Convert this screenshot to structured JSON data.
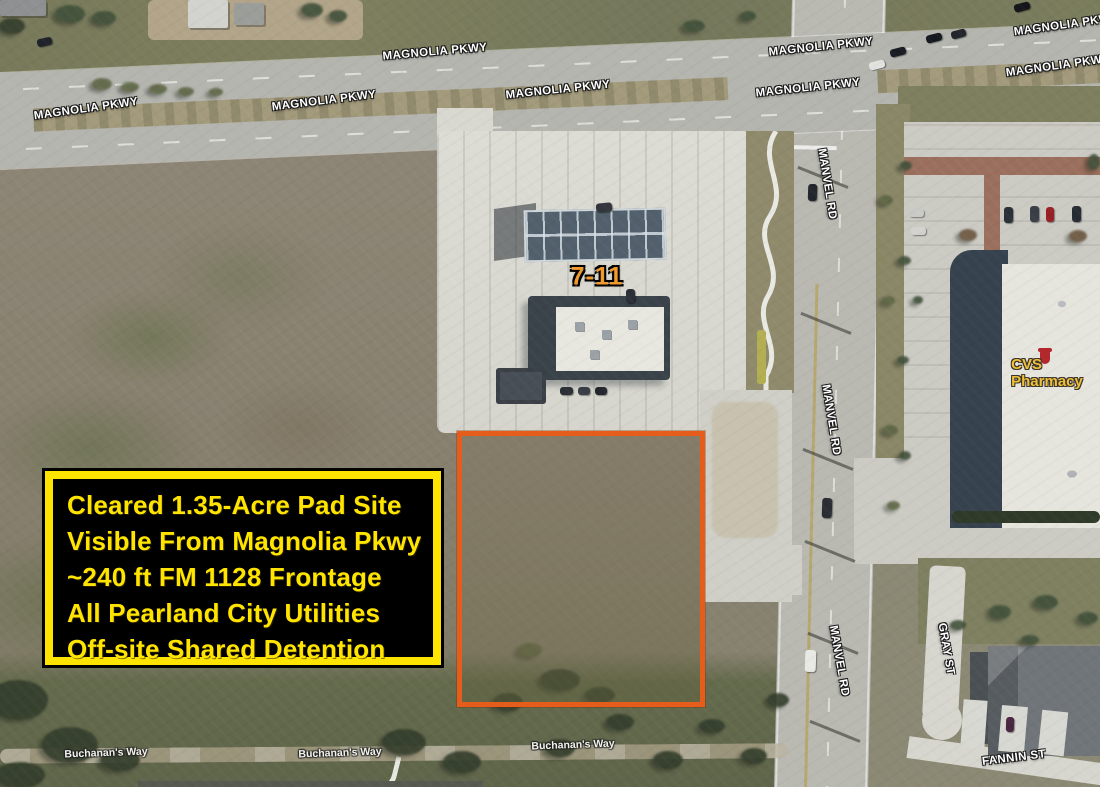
{
  "title_box": {
    "lines": [
      "Cleared 1.35-Acre Pad Site",
      "Visible From Magnolia Pkwy",
      "~240 ft FM 1128 Frontage",
      "All Pearland City Utilities",
      "Off-site Shared Detention"
    ],
    "text_color": "#FFE400",
    "background": "#000000",
    "border_color": "#FFE400"
  },
  "site_outline": {
    "color": "#E65C1B"
  },
  "roads": {
    "magnolia_pkwy": [
      "MAGNOLIA PKWY",
      "MAGNOLIA PKWY",
      "MAGNOLIA PKWY",
      "MAGNOLIA PKWY",
      "MAGNOLIA PKWY",
      "MAGNOLIA PKWY",
      "MAGNOLIA PKWY",
      "MAGNOLIA PKWY"
    ],
    "manvel_rd": [
      "MANVEL RD",
      "MANVEL RD",
      "MANVEL RD"
    ],
    "gray_st": "GRAY ST",
    "fannin_st": "FANNIN ST",
    "buchanans_way": [
      "Buchanan's Way",
      "Buchanan's Way",
      "Buchanan's Way"
    ]
  },
  "places": {
    "seven_eleven": "7-11",
    "cvs_pharmacy": "CVS Pharmacy"
  }
}
